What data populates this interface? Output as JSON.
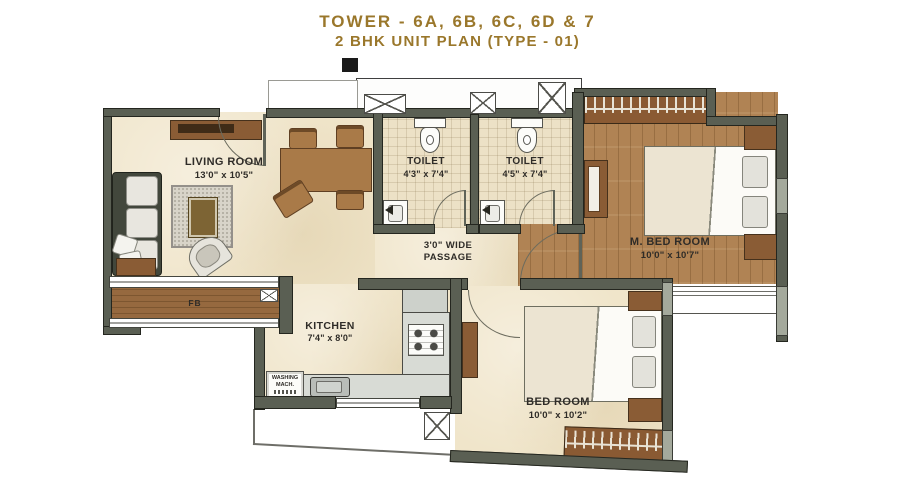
{
  "title": {
    "line1": "TOWER - 6A, 6B, 6C, 6D & 7",
    "line2": "2 BHK UNIT PLAN (TYPE - 01)"
  },
  "rooms": {
    "living": {
      "name": "LIVING ROOM",
      "dims": "13'0\" x 10'5\""
    },
    "toilet1": {
      "name": "TOILET",
      "dims": "4'3\" x 7'4\""
    },
    "toilet2": {
      "name": "TOILET",
      "dims": "4'5\" x 7'4\""
    },
    "master_bedroom": {
      "name": "M. BED ROOM",
      "dims": "10'0\" x 10'7\""
    },
    "bedroom": {
      "name": "BED ROOM",
      "dims": "10'0\" x 10'2\""
    },
    "kitchen": {
      "name": "KITCHEN",
      "dims": "7'4\" x 8'0\""
    },
    "passage": {
      "line1": "3'0\" WIDE",
      "line2": "PASSAGE"
    },
    "flower_bed": {
      "label": "FB"
    },
    "washing_machine": {
      "line1": "WASHING",
      "line2": "MACH."
    }
  },
  "colors": {
    "title_text": "#9a772b",
    "wall": "#5a5f53",
    "floor_beige": "#f0e5ca",
    "floor_wood": "#b08354",
    "label_text": "#2f2c28"
  }
}
